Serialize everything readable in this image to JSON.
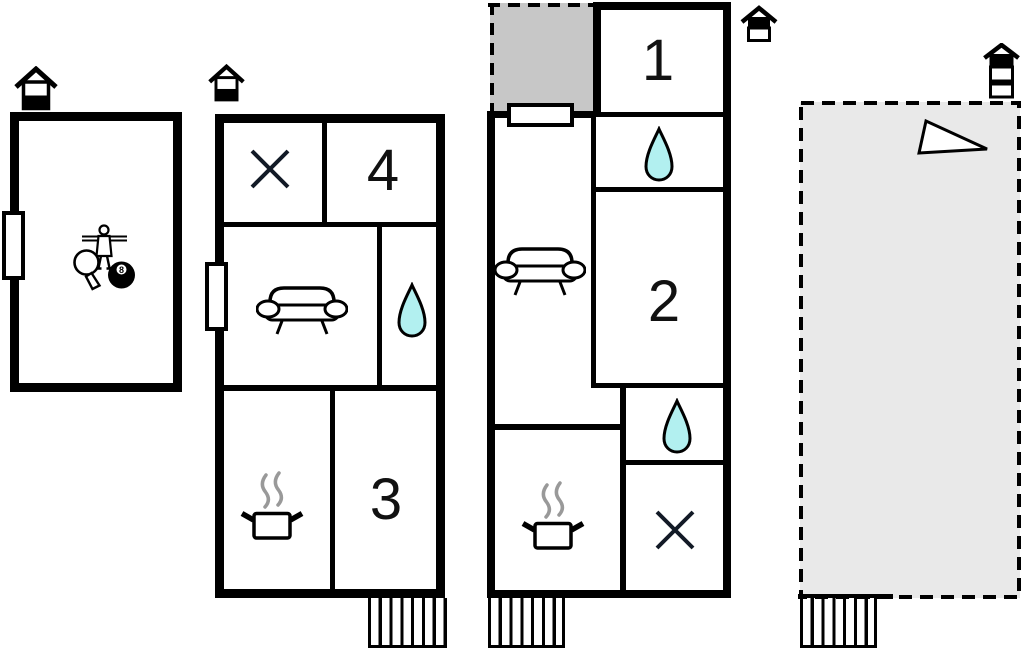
{
  "document": {
    "type": "vacation-home floor plan"
  },
  "colors": {
    "wall": "#000000",
    "water": "#b2f0f0",
    "court_gray": "#c7c7c7",
    "terrace_gray": "#e9e9e9",
    "steam": "#999999",
    "background": "#ffffff"
  },
  "labels": {
    "bedroom_1": "1",
    "bedroom_2": "2",
    "bedroom_3": "3",
    "bedroom_4": "4",
    "billiard_ball": "8"
  },
  "floor_plan": {
    "buildings": [
      {
        "name": "activity-house",
        "floor_marker_icon": "house-ground-floor-icon",
        "feature_icons": [
          "table-football-icon",
          "table-tennis-icon",
          "billiards-8ball-icon"
        ],
        "doors": 1
      },
      {
        "name": "main-house-ground-floor",
        "floor_marker_icon": "house-ground-floor-icon",
        "rooms": [
          "cross-room",
          "bedroom-4",
          "lounge-sofa",
          "bath-water-drop",
          "kitchen-pot",
          "bedroom-3"
        ],
        "doors": 1,
        "stairs": true
      },
      {
        "name": "annex-house",
        "floor_marker_icon": "house-upper-floor-icon",
        "rooms": [
          "gray-court",
          "bedroom-1",
          "bath-water-drop",
          "bedroom-2",
          "lounge-sofa",
          "bath-water-drop-2",
          "kitchen-pot",
          "cross-room"
        ],
        "doors": 1,
        "stairs": true
      },
      {
        "name": "terrace-area",
        "floor_marker_icon": "house-top-floor-icon",
        "feature_icons": [
          "sloping-terrain-icon"
        ],
        "stairs": true
      }
    ]
  }
}
